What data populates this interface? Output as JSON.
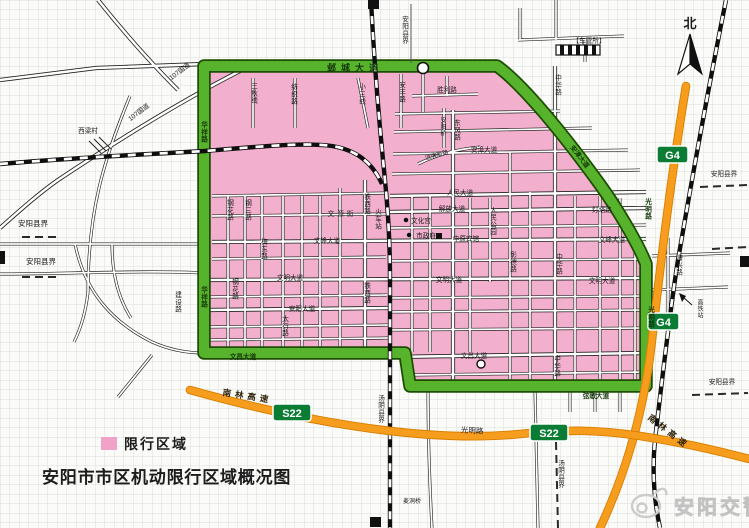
{
  "map": {
    "title": "安阳市市区机动限行区域概况图",
    "compass": "北",
    "watermark": "安阳交警",
    "legend": {
      "label": "限行区域",
      "swatch_color": "#f0a3c6"
    },
    "colors": {
      "restricted_fill": "#f2a9ca",
      "boundary_road_green": "#58b32c",
      "highway_orange": "#f69d1d",
      "badge_green": "#0a7c33",
      "railway_black": "#111111",
      "watermark_gray": "#d9d9d9"
    },
    "badges": {
      "g4": "G4",
      "s22": "S22"
    },
    "labels": {
      "yecheng": "邺城大道",
      "huaxiang": "华祥路",
      "wenchang": "文昌大道",
      "xiange": "弦歌大道",
      "guangming": "光明路",
      "anzhang": "安漳大道",
      "nanlin": "南林高速",
      "anyang_border": "安阳县界",
      "tangyin_border": "汤阴县界",
      "xiliang": "西梁村",
      "g107": "107国道",
      "cheguansuo": "【车管所】",
      "gaotie": "高铁站",
      "maidong": "麦洞桥",
      "huochezhan": "火车站",
      "sanqiu": "三秋线",
      "fangzhi": "纺织路",
      "xiaosan": "小三线",
      "anfeng": "安丰路",
      "shengli": "胜利路",
      "zhonghua": "中华路",
      "dongfeng": "东风路",
      "anyangqiao": "安阳桥",
      "huanbin": "洹滨南路",
      "renmin": "人民大道",
      "jiefang": "解放大道",
      "dengta": "灯塔路",
      "wenhuagong": "文化宫",
      "shizhengfu": "市政府",
      "zhongyuan": "中原宾馆",
      "renmin_park": "人民公园",
      "wenyuan": "文源街",
      "wenfeng": "文峰大道",
      "wenming": "文明大道",
      "anyang_ave": "安阳大道",
      "taihang": "太行路",
      "meidong": "梅东路",
      "ganghua": "钢花路",
      "gangsan": "钢三路",
      "tiexi": "铁西路",
      "zhangde": "彰德路",
      "haixing": "海兴路",
      "jianshe": "建设路"
    }
  }
}
